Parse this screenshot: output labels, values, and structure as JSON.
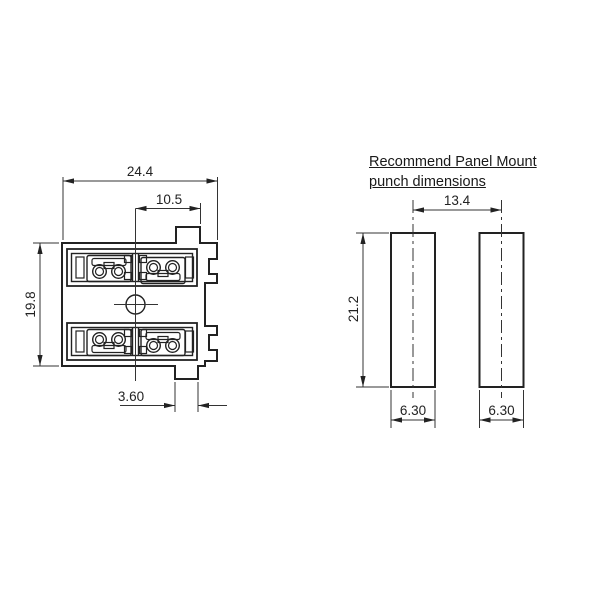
{
  "page": {
    "background": "#ffffff",
    "line_color": "#222222"
  },
  "front_view": {
    "description": "connector front view",
    "dims": {
      "overall_width": "24.4",
      "center_to_edge": "10.5",
      "overall_height": "19.8",
      "mount_tab_width": "3.60"
    }
  },
  "punch_view": {
    "title_line1": "Recommend Panel Mount",
    "title_line2": "punch dimensions",
    "dims": {
      "slot_center_spacing": "13.4",
      "slot_length": "21.2",
      "left_slot_width": "6.30",
      "right_slot_width": "6.30"
    }
  }
}
